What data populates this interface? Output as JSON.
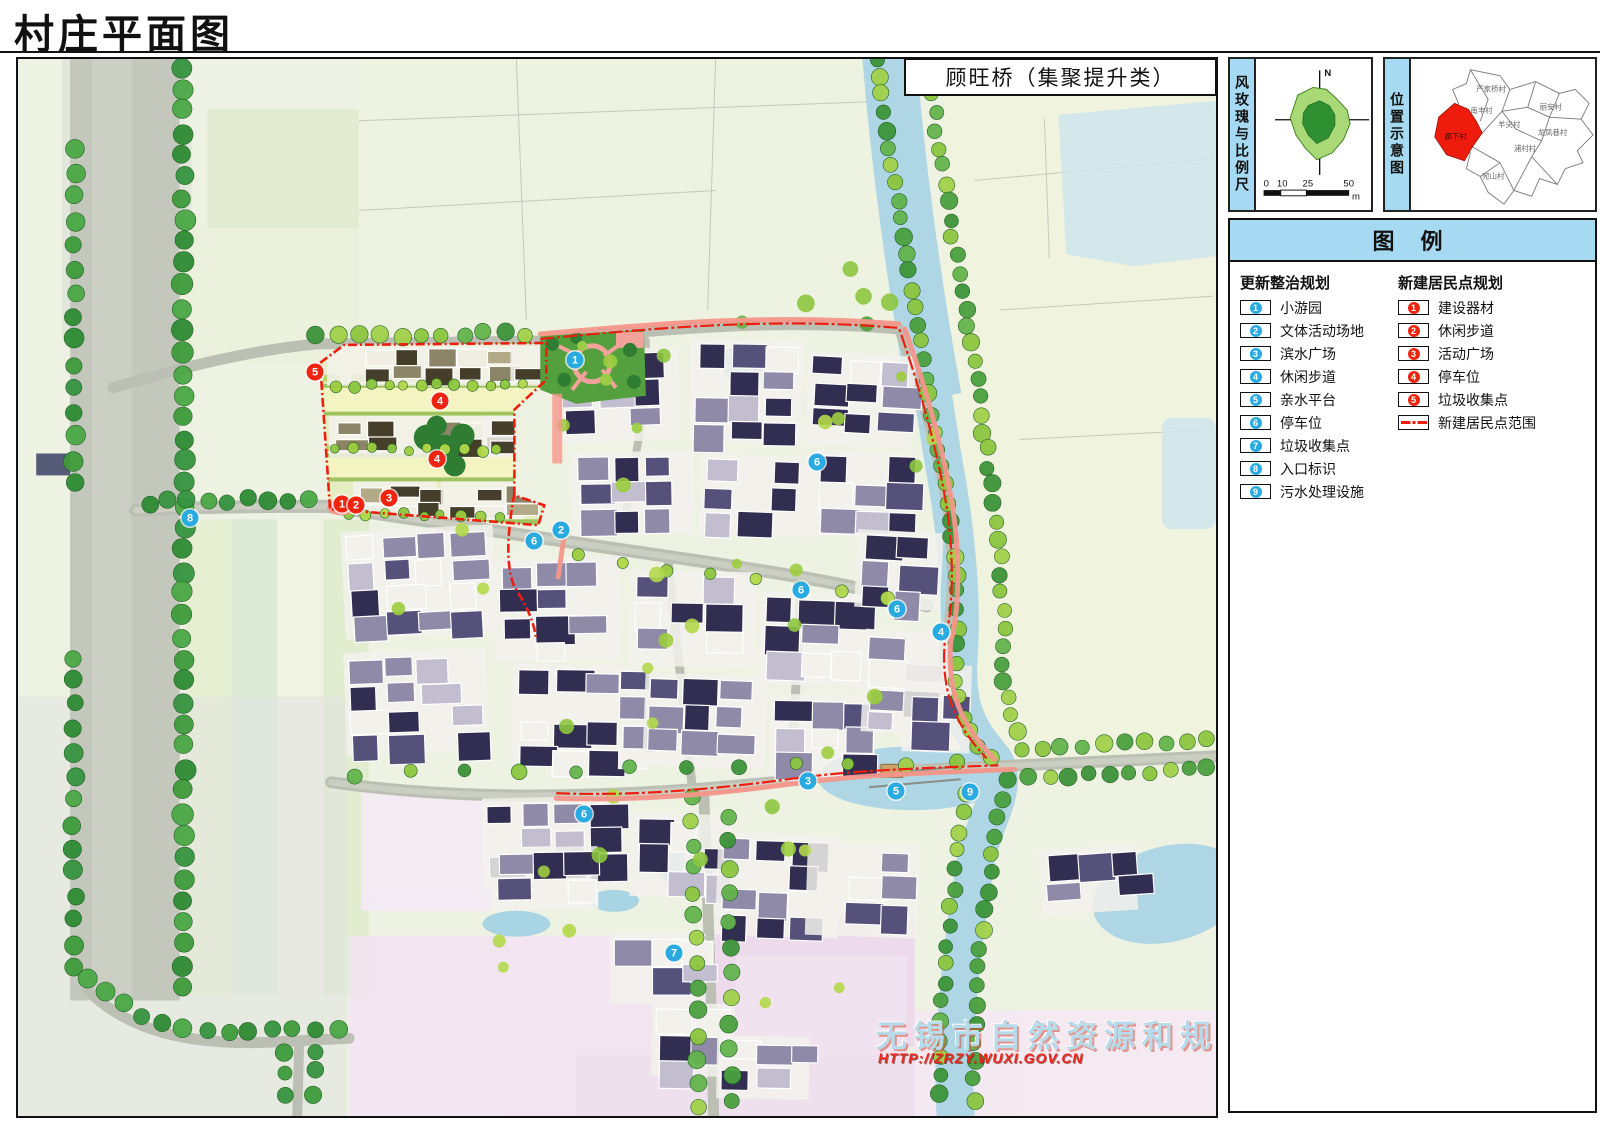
{
  "title": "村庄平面图",
  "map": {
    "title_box": "顾旺桥（集聚提升类）",
    "watermark_line1": "无锡市自然资源和规划局",
    "watermark_line2": "HTTP://ZRZY.WUXI.GOV.CN",
    "colors": {
      "marker_blue": "#29abe2",
      "marker_red": "#ee2411",
      "boundary_red": "#ee1d0e"
    },
    "markers_renewal": [
      {
        "n": "1",
        "x": 557,
        "y": 301
      },
      {
        "n": "2",
        "x": 543,
        "y": 471
      },
      {
        "n": "6",
        "x": 516,
        "y": 482
      },
      {
        "n": "8",
        "x": 172,
        "y": 459
      },
      {
        "n": "6",
        "x": 799,
        "y": 403
      },
      {
        "n": "6",
        "x": 783,
        "y": 531
      },
      {
        "n": "6",
        "x": 879,
        "y": 550
      },
      {
        "n": "4",
        "x": 923,
        "y": 573
      },
      {
        "n": "3",
        "x": 790,
        "y": 722
      },
      {
        "n": "5",
        "x": 878,
        "y": 732
      },
      {
        "n": "9",
        "x": 952,
        "y": 733
      },
      {
        "n": "6",
        "x": 566,
        "y": 755
      },
      {
        "n": "7",
        "x": 656,
        "y": 894
      }
    ],
    "markers_new": [
      {
        "n": "5",
        "x": 297,
        "y": 313
      },
      {
        "n": "4",
        "x": 422,
        "y": 342
      },
      {
        "n": "4",
        "x": 419,
        "y": 400
      },
      {
        "n": "3",
        "x": 371,
        "y": 439
      },
      {
        "n": "1",
        "x": 324,
        "y": 445
      },
      {
        "n": "2",
        "x": 338,
        "y": 446
      }
    ]
  },
  "panels": {
    "wind": {
      "label": "风玫瑰与比例尺",
      "north": "N",
      "scale_ticks": [
        "0",
        "10",
        "25",
        "50"
      ],
      "unit": "m"
    },
    "location": {
      "label": "位置示意图",
      "highlight_village": "廊下村",
      "villages": [
        {
          "name": "严家桥村"
        },
        {
          "name": "南丰村"
        },
        {
          "name": "丽安村"
        },
        {
          "name": "羊尖村"
        },
        {
          "name": "龙凤巷村"
        },
        {
          "name": "浦村村"
        },
        {
          "name": "宛山村"
        },
        {
          "name": "廊下村"
        }
      ]
    }
  },
  "legend": {
    "header": "图 例",
    "renewal": {
      "title": "更新整治规划",
      "items": [
        {
          "n": "1",
          "label": "小游园"
        },
        {
          "n": "2",
          "label": "文体活动场地"
        },
        {
          "n": "3",
          "label": "滨水广场"
        },
        {
          "n": "4",
          "label": "休闲步道"
        },
        {
          "n": "5",
          "label": "亲水平台"
        },
        {
          "n": "6",
          "label": "停车位"
        },
        {
          "n": "7",
          "label": "垃圾收集点"
        },
        {
          "n": "8",
          "label": "入口标识"
        },
        {
          "n": "9",
          "label": "污水处理设施"
        }
      ]
    },
    "new_area": {
      "title": "新建居民点规划",
      "items": [
        {
          "n": "1",
          "label": "建设器材"
        },
        {
          "n": "2",
          "label": "休闲步道"
        },
        {
          "n": "3",
          "label": "活动广场"
        },
        {
          "n": "4",
          "label": "停车位"
        },
        {
          "n": "5",
          "label": "垃圾收集点"
        }
      ],
      "range_label": "新建居民点范围"
    }
  }
}
